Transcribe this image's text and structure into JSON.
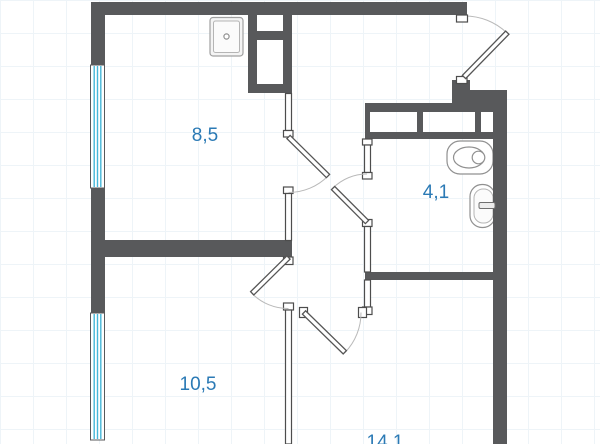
{
  "rooms": [
    {
      "name": "kitchen-living",
      "area_label": "8,5"
    },
    {
      "name": "bathroom",
      "area_label": "4,1"
    },
    {
      "name": "room-lower-left",
      "area_label": "10,5"
    },
    {
      "name": "room-lower-right",
      "area_label": "14,1"
    }
  ],
  "colors": {
    "wall": "#58595b",
    "window_glass": "#45b7d9",
    "room_label": "#2b7ab5",
    "door_arc": "#b9b9b9",
    "fixture_outline": "#909090"
  },
  "fixtures": [
    {
      "icon": "kitchen-sink-icon"
    },
    {
      "icon": "toilet-icon"
    },
    {
      "icon": "washbasin-icon"
    }
  ]
}
